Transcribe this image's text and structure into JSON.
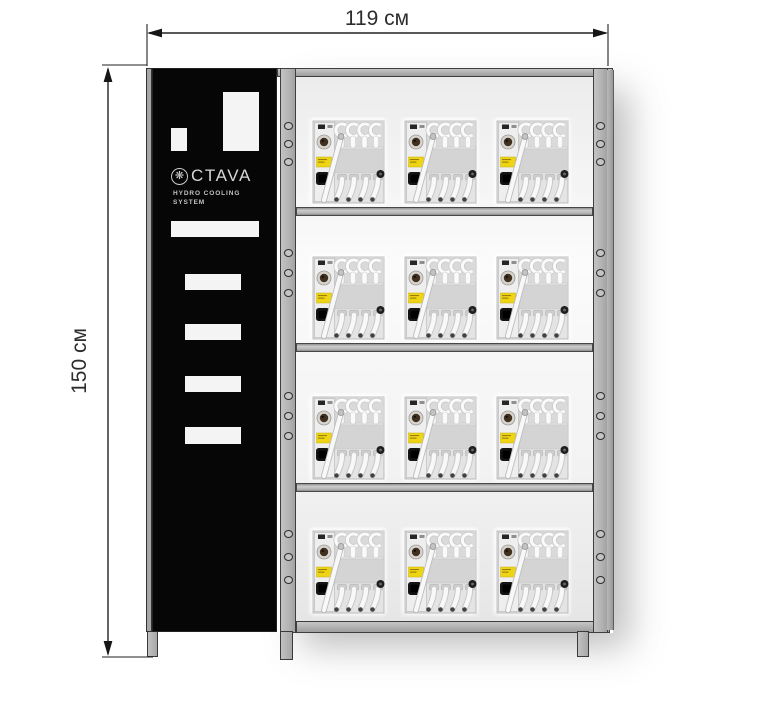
{
  "dimension_annotations": {
    "width": "119 см",
    "height": "150 см"
  },
  "cabinet_panel": {
    "brand_icon": "fan-icon",
    "brand_text": "CTAVA",
    "brand_full": "OCTAVA",
    "tagline_top": "HYDRO COOLING",
    "tagline_bottom": "SYSTEM"
  },
  "rack": {
    "shelves": 4,
    "units_per_shelf": 3,
    "total_units": 12,
    "unit_type": "hydro-cooling-unit"
  },
  "colors": {
    "frame_gray": "#b2b2b2",
    "panel_black": "#060606",
    "sticker_yellow": "#efd414",
    "dimension_text": "#2d2d2d",
    "interior_light": "#f3f3f3"
  }
}
